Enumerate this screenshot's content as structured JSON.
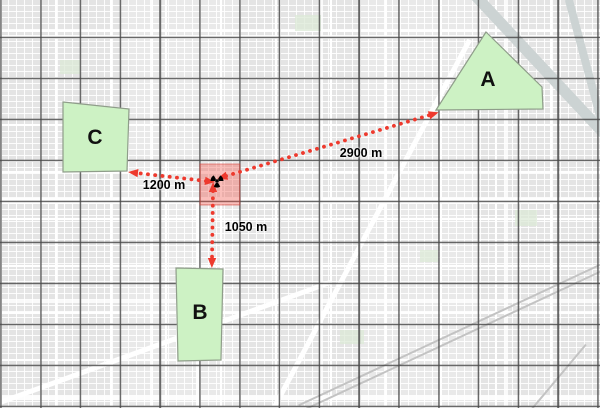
{
  "colors": {
    "arrow_red": "#ee3a2e",
    "zone_fill": "#cdf2c4",
    "zone_border": "#8f9d8a",
    "hazard_fill": "rgba(240,68,58,0.35)",
    "hazard_border": "rgba(214,60,52,0.55)",
    "grid_line": "#484848",
    "label_color": "#111111"
  },
  "zones": [
    {
      "id": "A",
      "label": "A",
      "points": [
        [
          486,
          32
        ],
        [
          542,
          87
        ],
        [
          543,
          109
        ],
        [
          436,
          110
        ]
      ],
      "label_x": 488,
      "label_y": 80
    },
    {
      "id": "B",
      "label": "B",
      "points": [
        [
          176,
          268
        ],
        [
          223,
          269
        ],
        [
          221,
          360
        ],
        [
          178,
          361
        ]
      ],
      "label_x": 200,
      "label_y": 313
    },
    {
      "id": "C",
      "label": "C",
      "points": [
        [
          63,
          102
        ],
        [
          129,
          109
        ],
        [
          127,
          171
        ],
        [
          63,
          172
        ]
      ],
      "label_x": 95,
      "label_y": 138
    }
  ],
  "hazard_cell": {
    "x": 200,
    "y": 164,
    "width": 39.8,
    "height": 41,
    "marker_icon": "radiation-icon",
    "marker_x": 217,
    "marker_y": 181
  },
  "measurements": [
    {
      "zone": "A",
      "label": "2900 m",
      "x1": 226,
      "y1": 176,
      "x2": 430,
      "y2": 115,
      "label_x": 361,
      "label_y": 153
    },
    {
      "zone": "C",
      "label": "1200 m",
      "x1": 206,
      "y1": 181,
      "x2": 137,
      "y2": 173,
      "label_x": 164,
      "label_y": 185
    },
    {
      "zone": "B",
      "label": "1050 m",
      "x1": 213,
      "y1": 191,
      "x2": 212,
      "y2": 259,
      "label_x": 246,
      "label_y": 227
    }
  ]
}
